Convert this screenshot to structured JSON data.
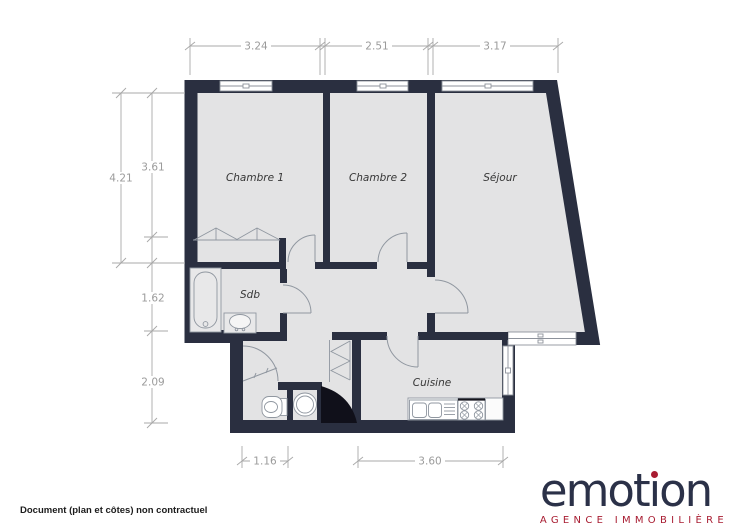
{
  "document": {
    "type": "floorplan",
    "background": "#ffffff"
  },
  "floorplan": {
    "rooms": [
      {
        "label": "Chambre 1"
      },
      {
        "label": "Chambre 2"
      },
      {
        "label": "Séjour"
      },
      {
        "label": "Sdb"
      },
      {
        "label": "Cuisine"
      }
    ],
    "dimensions": {
      "top": [
        "3.24",
        "2.51",
        "3.17"
      ],
      "left_outer": "4.21",
      "left_inner": [
        "3.61",
        "1.62",
        "2.09"
      ],
      "bottom": [
        "1.16",
        "3.60"
      ]
    },
    "fixtures": [
      "bathtub",
      "washbasin",
      "toilet",
      "washing-machine",
      "kitchen-sink",
      "stove",
      "wardrobe",
      "duct-shaft"
    ],
    "colors": {
      "wall": "#2a2f40",
      "floor": "#e3e3e4",
      "fixture_line": "#9097a0",
      "dimension": "#9b9b9b",
      "shaft": "#10101a"
    }
  },
  "footer": {
    "disclaimer": "Document (plan et côtes) non contractuel"
  },
  "logo": {
    "name": "emotion",
    "name_pre": "emot",
    "name_i": "ı",
    "name_post": "on",
    "tagline": "AGENCE IMMOBILIÈRE",
    "navy": "#2b3148",
    "red": "#a81c31"
  }
}
